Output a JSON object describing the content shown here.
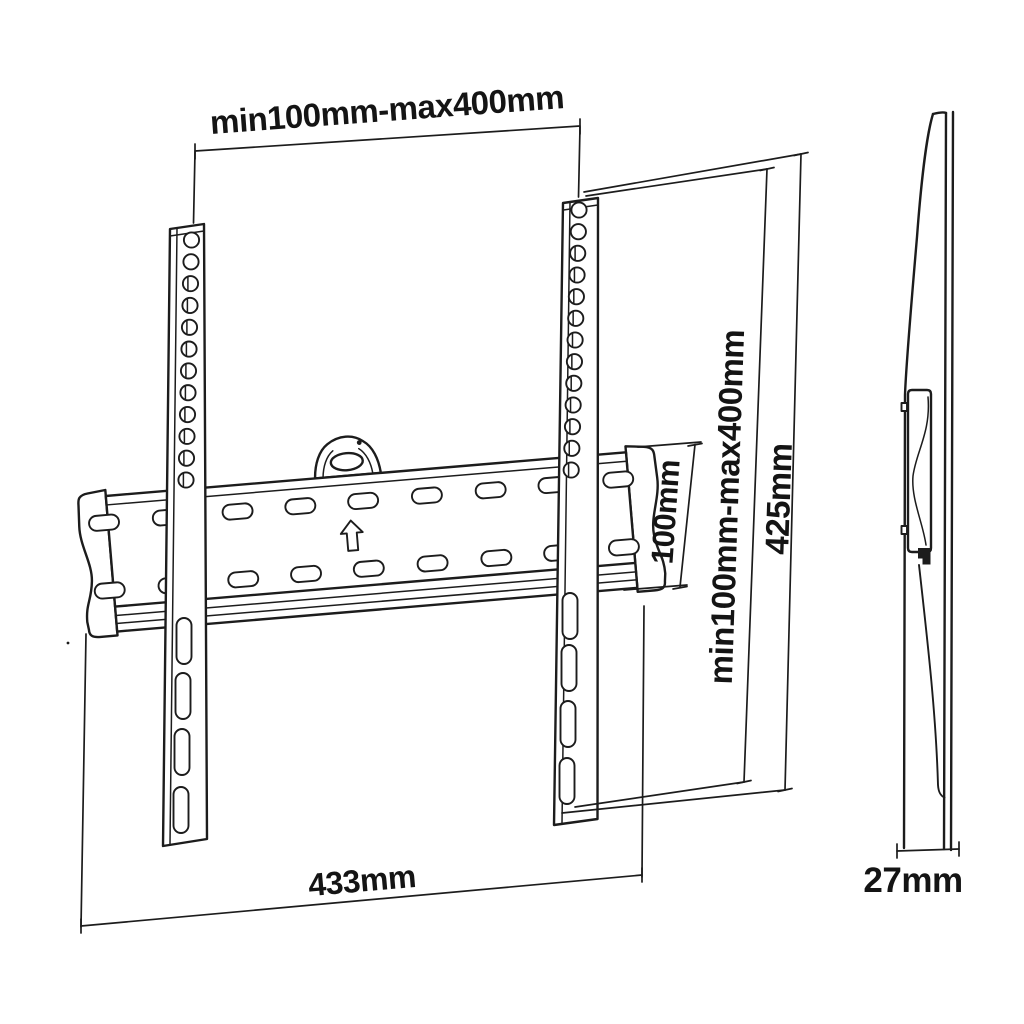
{
  "drawing": {
    "type": "tv-wall-mount-dimension-drawing",
    "background_color": "#ffffff",
    "line_color": "#1c1c1c",
    "dimensions": {
      "top_width": "min100mm-max400mm",
      "plate_width": "433mm",
      "vesa_vertical": "min100mm-max400mm",
      "bracket_height": "425mm",
      "plate_height": "100mm",
      "depth": "27mm"
    },
    "icons": {
      "up_arrow": "up-arrow-icon",
      "latch": "latch-hook-icon"
    },
    "features": {
      "rail_hole_count_left": 12,
      "rail_hole_count_right": 13,
      "rail_bottom_slots_per_rail": 4,
      "plate_slot_rows": 2
    }
  }
}
